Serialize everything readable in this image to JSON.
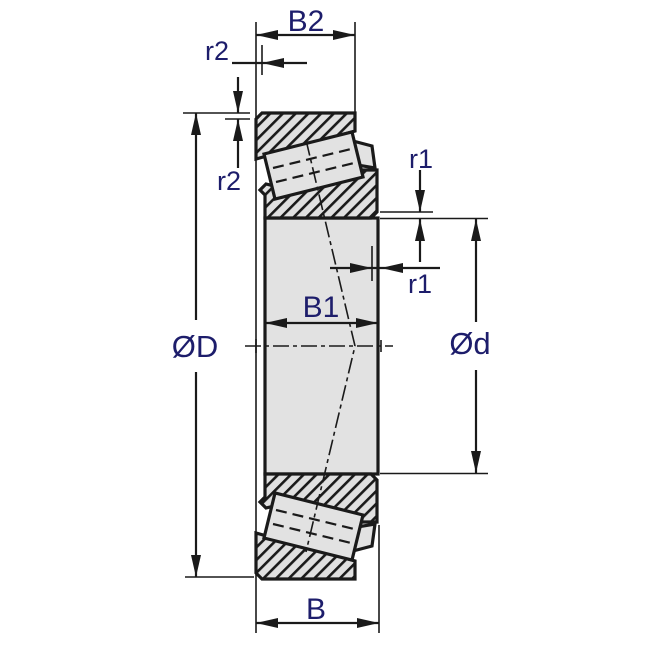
{
  "diagram": {
    "dimensions": {
      "outer_ring_width": "B2",
      "chamfer_outer_horizontal": "r2",
      "chamfer_outer_vertical": "r2",
      "chamfer_inner_vertical": "r1",
      "chamfer_inner_horizontal": "r1",
      "inner_ring_width": "B1",
      "outer_diameter": "ØD",
      "bore_diameter": "Ød",
      "overall_width": "B"
    },
    "colors": {
      "label_text": "#1d1d6b",
      "line": "#1a1a1a",
      "part_fill": "#e2e2e2",
      "hatch_background": "#e0e0e0",
      "background": "#ffffff"
    }
  }
}
